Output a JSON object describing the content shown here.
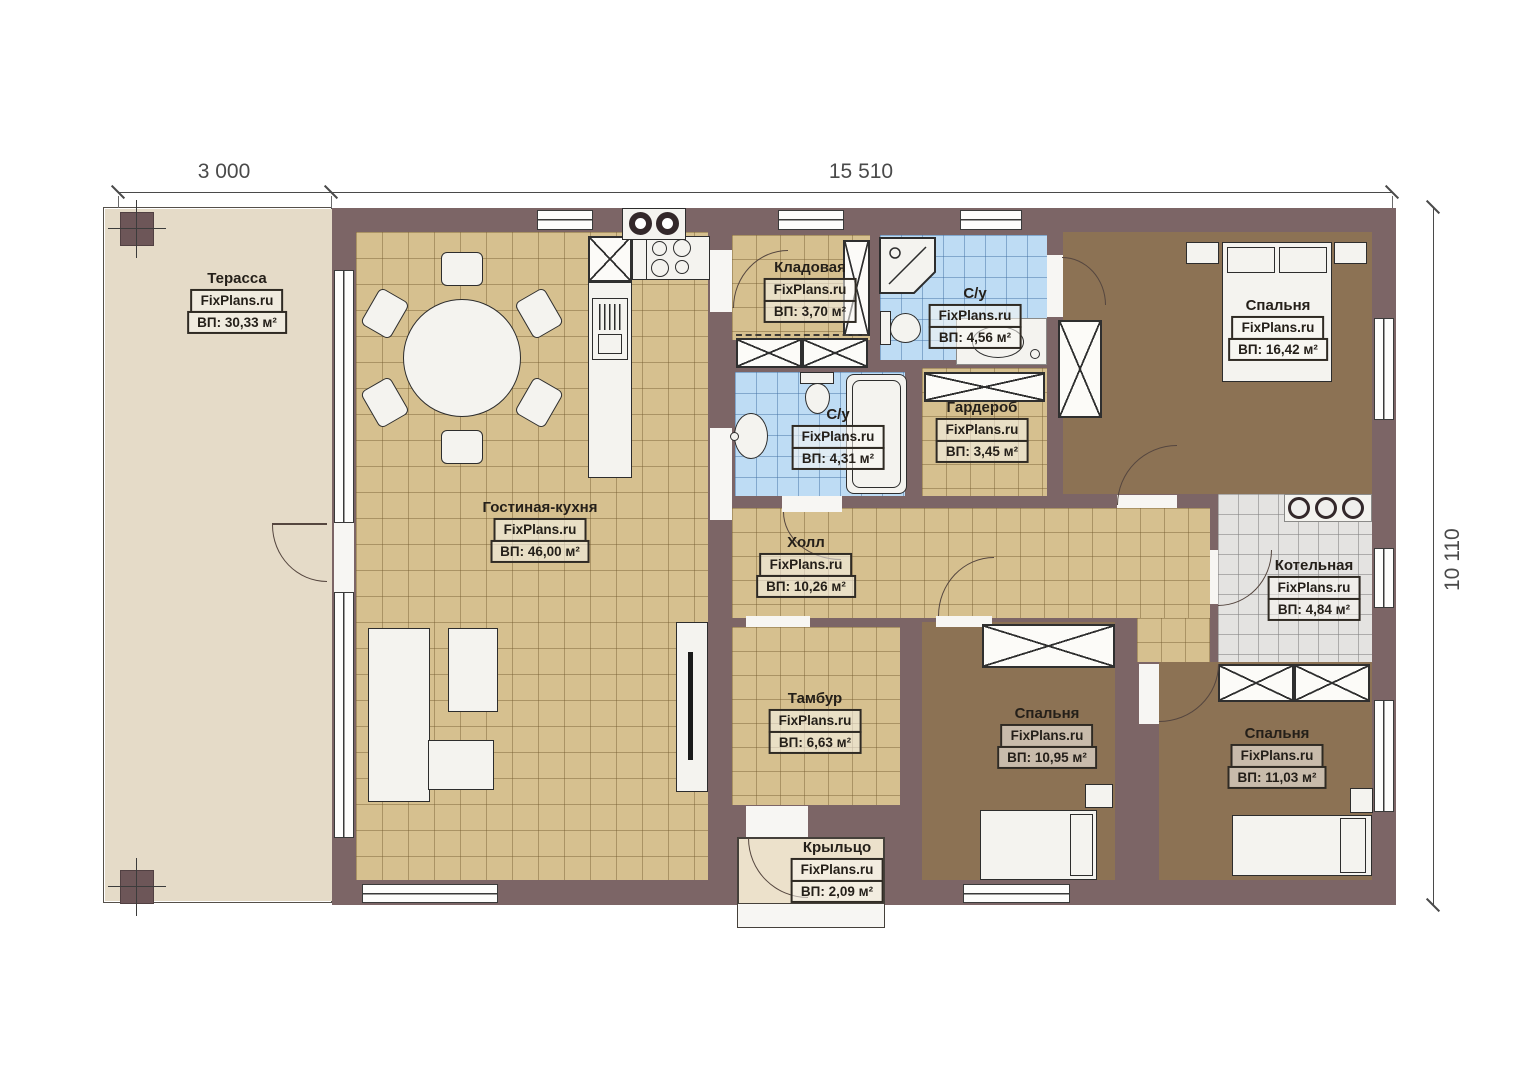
{
  "brand": "FixPlans.ru",
  "dimensions": {
    "width_terrace": "3 000",
    "width_house": "15 510",
    "height_house": "10 110"
  },
  "rooms": {
    "terrace": {
      "name": "Терасса",
      "area": "ВП: 30,33 м²"
    },
    "living_kitchen": {
      "name": "Гостиная-кухня",
      "area": "ВП: 46,00 м²"
    },
    "storage": {
      "name": "Кладовая",
      "area": "ВП: 3,70 м²"
    },
    "bathroom_top": {
      "name": "С/у",
      "area": "ВП: 4,56 м²"
    },
    "bedroom_master": {
      "name": "Спальня",
      "area": "ВП: 16,42 м²"
    },
    "bathroom_mid": {
      "name": "С/у",
      "area": "ВП: 4,31 м²"
    },
    "wardrobe": {
      "name": "Гардероб",
      "area": "ВП: 3,45 м²"
    },
    "hall": {
      "name": "Холл",
      "area": "ВП: 10,26 м²"
    },
    "boiler": {
      "name": "Котельная",
      "area": "ВП: 4,84 м²"
    },
    "vestibule": {
      "name": "Тамбур",
      "area": "ВП: 6,63 м²"
    },
    "bedroom_mid": {
      "name": "Спальня",
      "area": "ВП: 10,95 м²"
    },
    "bedroom_right": {
      "name": "Спальня",
      "area": "ВП: 11,03 м²"
    },
    "porch": {
      "name": "Крыльцо",
      "area": "ВП: 2,09 м²"
    }
  },
  "colors": {
    "wall": "#7c6566",
    "floor_tile_tan": "#d6c08f",
    "floor_bedroom": "#8c7254",
    "floor_bath": "#bedcf4",
    "floor_boiler": "#e4e3e1",
    "terrace": "#e5dbc8",
    "porch": "#ece1cb"
  }
}
